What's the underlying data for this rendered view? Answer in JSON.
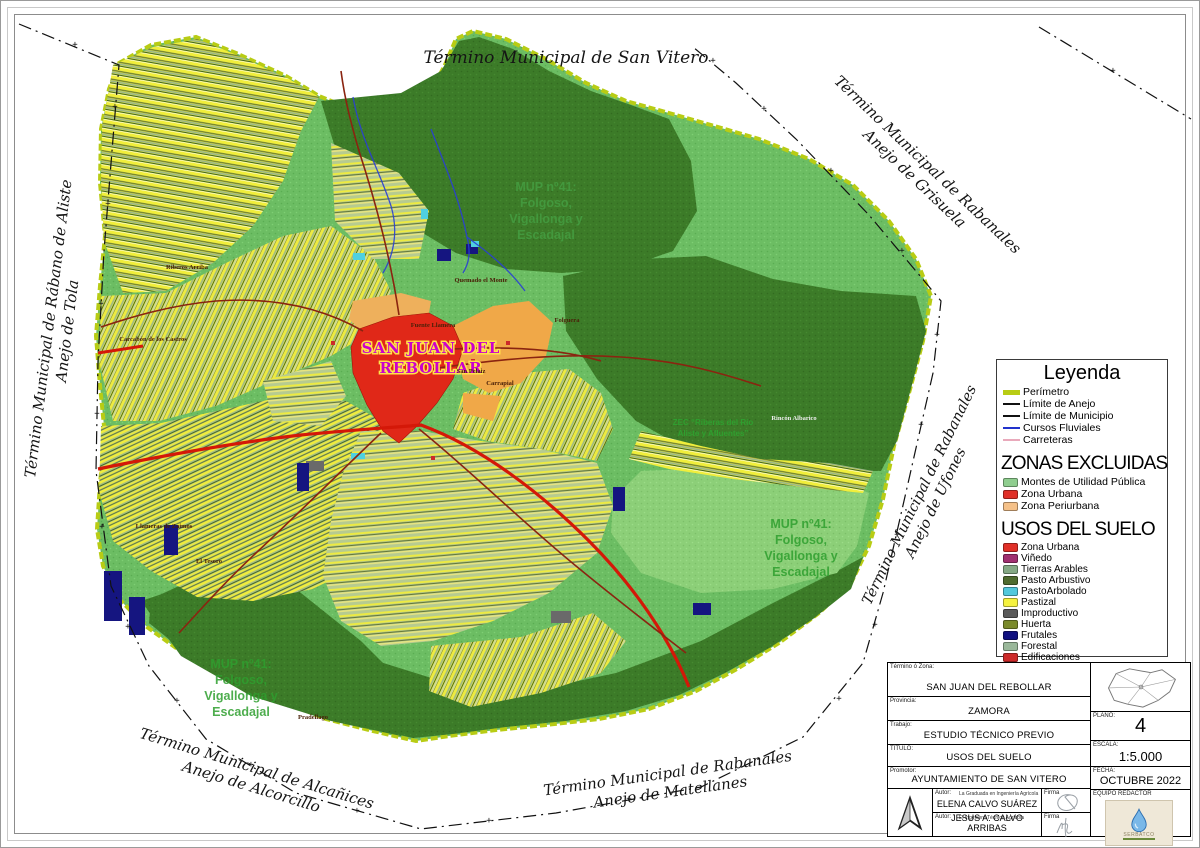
{
  "boundary_labels": {
    "top": {
      "lines": [
        "Término Municipal de San Vitero"
      ]
    },
    "top_right": {
      "lines": [
        "Término Municipal de Rabanales",
        "Anejo de Grisuela"
      ]
    },
    "left": {
      "lines": [
        "Término Municipal de Rábano de Aliste",
        "Anejo de Tola"
      ]
    },
    "right": {
      "lines": [
        "Término Municipal de Rabanales",
        "Anejo de Ufones"
      ]
    },
    "bottom_left": {
      "lines": [
        "Término Municipal de Alcañices",
        "Anejo de  Alcorcillo"
      ]
    },
    "bottom": {
      "lines": [
        "Término Municipal de Rabanales",
        "Anejo de Matellanes"
      ]
    }
  },
  "map_labels": {
    "town_lines": [
      "SAN JUAN DEL",
      "REBOLLAR"
    ],
    "mup_lines": [
      "MUP nº41:",
      "Folgoso,",
      "Vigallonga y",
      "Escadajal"
    ],
    "zec_lines": [
      "ZEC “Riberas del Río",
      "Aliste y Afluentes”"
    ]
  },
  "place_labels": [
    {
      "name": "Carcabón de los Castros",
      "x": 152,
      "y": 340
    },
    {
      "name": "Riberos Arriba",
      "x": 186,
      "y": 268
    },
    {
      "name": "Fuente Llamera",
      "x": 432,
      "y": 326
    },
    {
      "name": "San Pelaiz",
      "x": 470,
      "y": 372
    },
    {
      "name": "Carrapial",
      "x": 499,
      "y": 384
    },
    {
      "name": "Folguera",
      "x": 566,
      "y": 321
    },
    {
      "name": "Rincón Albarico",
      "x": 793,
      "y": 419,
      "light": true
    },
    {
      "name": "Llameras de Zaimos",
      "x": 163,
      "y": 527
    },
    {
      "name": "El Tesoro",
      "x": 208,
      "y": 562
    },
    {
      "name": "Pradellago",
      "x": 312,
      "y": 718
    },
    {
      "name": "Quemado el Monte",
      "x": 480,
      "y": 281
    }
  ],
  "legend": {
    "title": "Leyenda",
    "line_items": [
      {
        "label": "Perímetro",
        "color": "#b8cc14",
        "thick": 5
      },
      {
        "label": "Límite de Anejo",
        "color": "#111111",
        "thick": 2
      },
      {
        "label": "Límite de Municipio",
        "color": "#111111",
        "thick": 2
      },
      {
        "label": "Cursos Fluviales",
        "color": "#2233cc",
        "thick": 2
      },
      {
        "label": "Carreteras",
        "color": "#e9a9bb",
        "thick": 2
      }
    ],
    "zonas_title": "ZONAS EXCLUIDAS",
    "zonas_items": [
      {
        "label": "Montes de Utilidad Pública",
        "color": "#8fce8f",
        "dots": true
      },
      {
        "label": "Zona Urbana",
        "color": "#e03028"
      },
      {
        "label": "Zona Periurbana",
        "color": "#f5c189"
      }
    ],
    "usos_title": "USOS DEL SUELO",
    "usos_items": [
      {
        "label": "Zona Urbana",
        "color": "#e03028"
      },
      {
        "label": "Viñedo",
        "color": "#a03070"
      },
      {
        "label": "Tierras Arables",
        "color": "#85a985"
      },
      {
        "label": "Pasto Arbustivo",
        "color": "#4f6b2f"
      },
      {
        "label": "PastoArbolado",
        "color": "#52c8dc"
      },
      {
        "label": "Pastizal",
        "color": "#f5f23f"
      },
      {
        "label": "Improductivo",
        "color": "#5a5a5a"
      },
      {
        "label": "Huerta",
        "color": "#7a8a2a"
      },
      {
        "label": "Frutales",
        "color": "#101080"
      },
      {
        "label": "Forestal",
        "color": "#9ab89a"
      },
      {
        "label": "Edificaciones",
        "color": "#cc2a2a"
      }
    ]
  },
  "title_block": {
    "rows": [
      {
        "label": "Término ó Zona:",
        "value": "SAN JUAN DEL REBOLLAR"
      },
      {
        "label": "Provincia:",
        "value": "ZAMORA"
      },
      {
        "label": "Trabajo:",
        "value": "ESTUDIO TÉCNICO PREVIO"
      },
      {
        "label": "TÍTULO:",
        "value": "USOS DEL SUELO"
      },
      {
        "label": "Promotor:",
        "value": "AYUNTAMIENTO DE SAN VITERO"
      }
    ],
    "authors": [
      {
        "label": "Autor:",
        "role": "La Graduada en Ingeniería Agrícola y del Medio Rural",
        "name": "ELENA CALVO SUÁREZ",
        "firma_label": "Firma"
      },
      {
        "label": "Autor:",
        "role": "El Ingeniero Técnico Agrícola",
        "name": "JESUS A. CALVO ARRIBAS",
        "firma_label": "Firma"
      }
    ],
    "side_fields": [
      {
        "label": "PLANO:",
        "value": "4",
        "size": 20,
        "height": 29
      },
      {
        "label": "ESCALA:",
        "value": "1:5.000",
        "size": 13,
        "height": 26
      },
      {
        "label": "FECHA:",
        "value": "OCTUBRE 2022",
        "size": 11,
        "height": 23
      }
    ],
    "equipo_label": "EQUIPO REDACTOR",
    "logo_text": "SERBATCO"
  }
}
